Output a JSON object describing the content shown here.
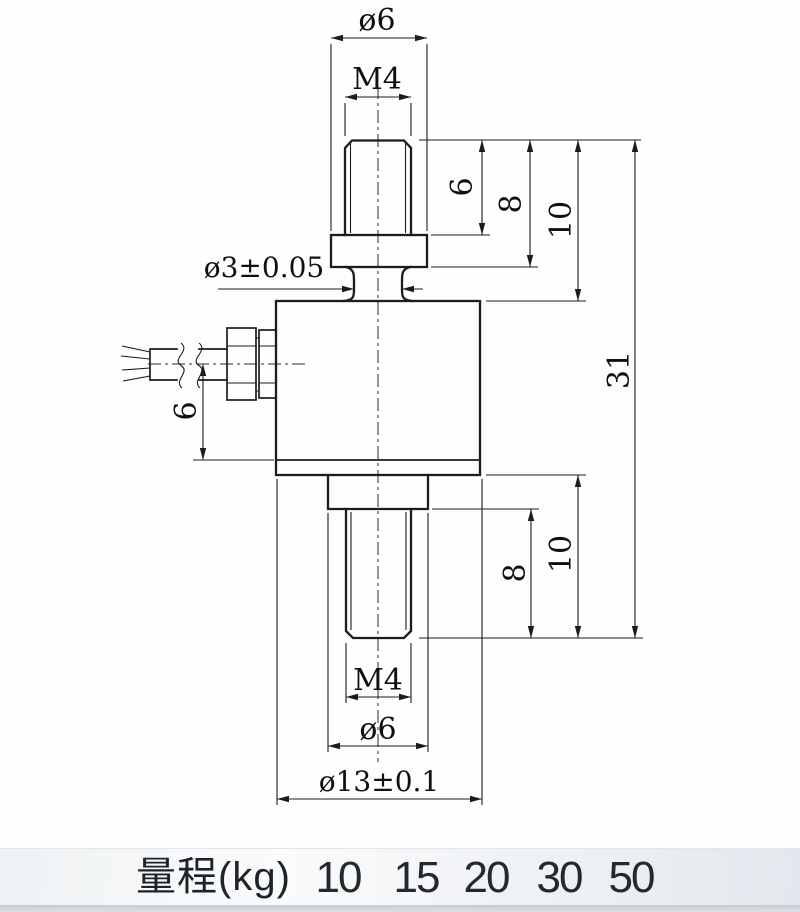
{
  "drawing": {
    "top": {
      "dia": "ø6",
      "thread": "M4",
      "thread_len": "6",
      "stud_len": "8",
      "section_len": "10"
    },
    "neck": {
      "dia": "ø3±0.05"
    },
    "cable": {
      "offset": "6"
    },
    "overall": {
      "height": "31"
    },
    "bottom": {
      "section_len": "10",
      "thread_len": "8",
      "thread": "M4",
      "dia": "ø6",
      "body_dia": "ø13±0.1"
    }
  },
  "range_table": {
    "label": "量程(kg)",
    "values": [
      "10",
      "15",
      "20",
      "30",
      "50"
    ]
  },
  "colors": {
    "line": "#1c1c1c",
    "strip_bg": "#edf0f4",
    "text": "#101010"
  }
}
